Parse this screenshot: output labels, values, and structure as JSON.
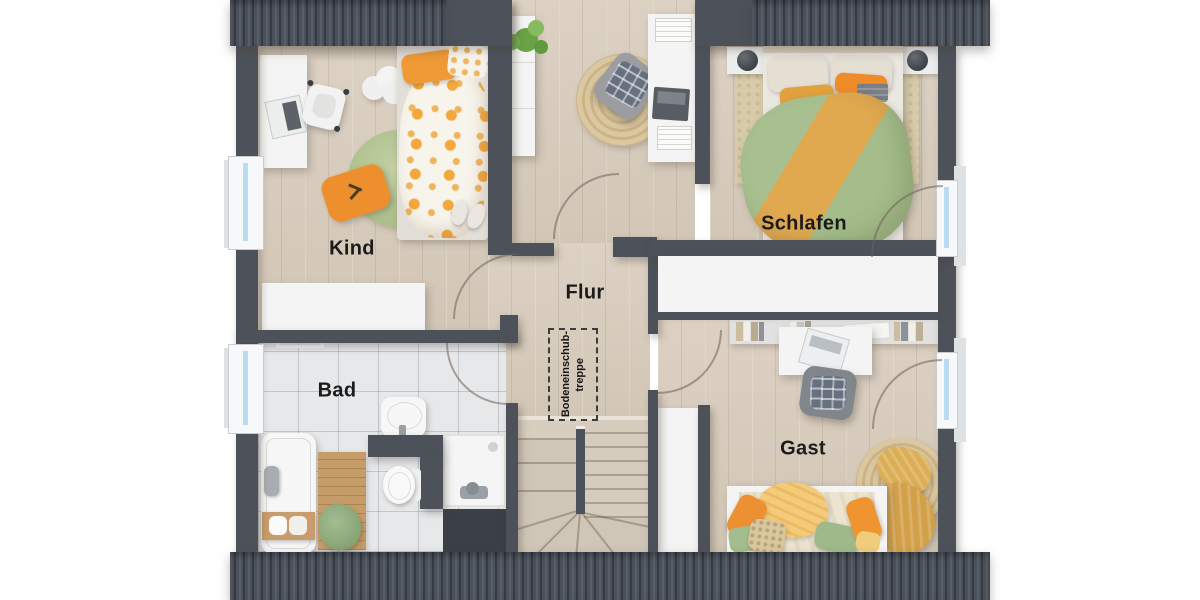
{
  "labels": {
    "kind": "Kind",
    "schlafen": "Schlafen",
    "flur": "Flur",
    "bad": "Bad",
    "gast": "Gast"
  },
  "annotations": {
    "loft_hatch": {
      "line1": "Bodeneinschub-",
      "line2": "treppe"
    }
  },
  "plan": {
    "type": "attic-floor-plan-top-view",
    "rooms": {
      "kind": {
        "label": "Kind",
        "furniture": [
          "desk",
          "desk-chair",
          "laptop",
          "cloud-side-table",
          "single-bed",
          "round-green-rug",
          "orange-floor-cushion",
          "slippers",
          "sideboard"
        ]
      },
      "schlafen": {
        "label": "Schlafen",
        "furniture": [
          "double-bed",
          "nightstand-left",
          "nightstand-right",
          "table-lamp-left",
          "table-lamp-right",
          "area-rug",
          "built-in-wardrobe"
        ]
      },
      "flur": {
        "label": "Flur",
        "furniture": [
          "shelf-with-plant",
          "reading-armchair",
          "round-jute-rug",
          "wall-desk",
          "laptop",
          "winder-staircase",
          "tall-cabinet"
        ]
      },
      "bad": {
        "label": "Bad",
        "furniture": [
          "bathtub",
          "bath-caddy",
          "wooden-mat",
          "towel-pile",
          "washbasin",
          "toilet",
          "shower",
          "towel-rail"
        ]
      },
      "gast": {
        "label": "Gast",
        "furniture": [
          "book-shelf",
          "desk",
          "laptop",
          "office-chair",
          "daybed",
          "round-jute-rug",
          "mustard-blanket"
        ]
      }
    },
    "openings": {
      "windows": [
        "kind-left-wall",
        "bad-left-wall",
        "schlafen-right-wall",
        "gast-right-wall"
      ],
      "door_swings": [
        "kind-door",
        "bad-door",
        "flur-top-door",
        "gast-door",
        "schlafen-window-swing",
        "gast-window-swing"
      ]
    },
    "stairs": {
      "type": "quarter-turn-winder-staircase"
    },
    "colors": {
      "wall": "#4d525a",
      "roof": "#4b515b",
      "wood_floor": "#d8ccbd",
      "bath_tile": "#e6e8ea",
      "accent_orange": "#ee9133",
      "accent_green": "#a8c28f",
      "accent_mustard": "#d9a94e",
      "window_glazing": "#badcf0",
      "furniture_white": "#f3f4f3"
    }
  }
}
